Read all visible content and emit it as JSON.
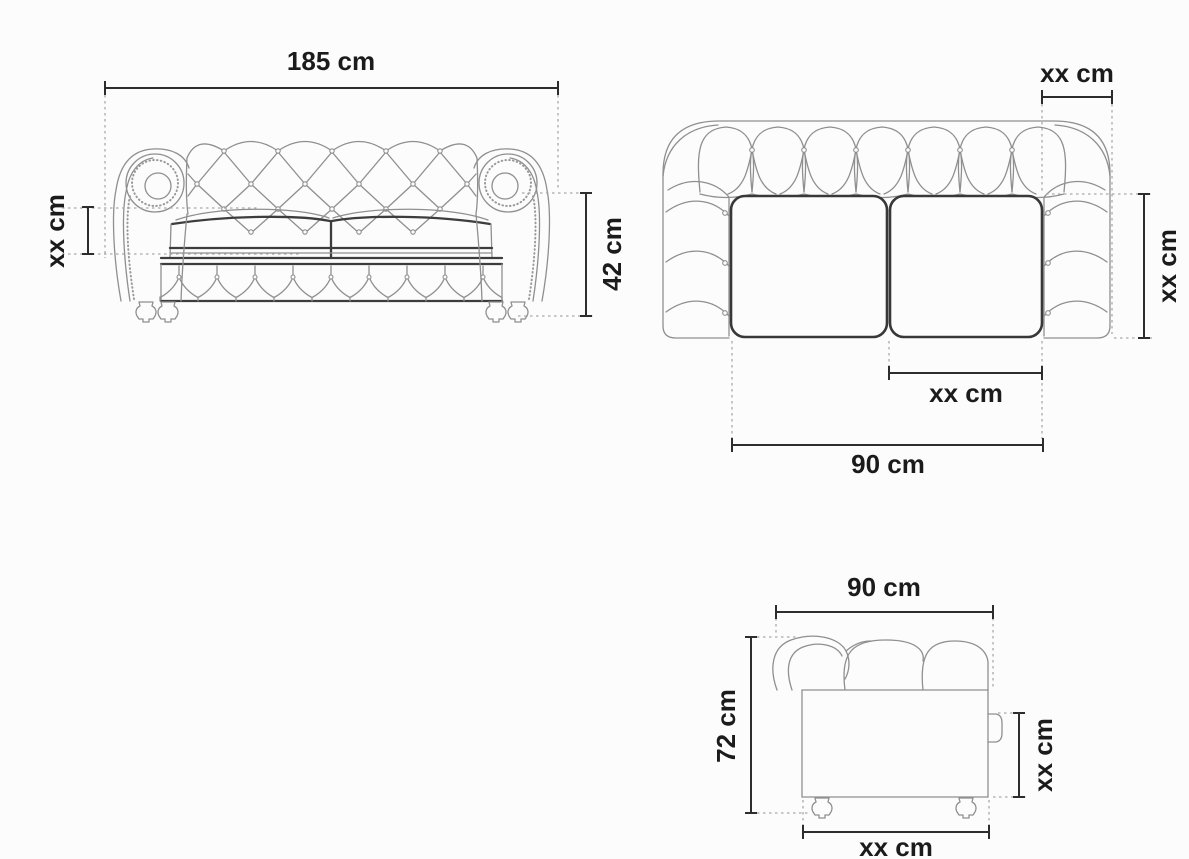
{
  "diagram": {
    "type": "furniture-dimension-drawing",
    "subject": "Chesterfield two-seater sofa shown in front, top and side views",
    "unit": "cm",
    "colors": {
      "background": "#fcfcfc",
      "artwork_line": "#8f8f8f",
      "dimension_line": "#2d2d2d",
      "extension_line": "#a8a8a8",
      "label_text": "#1b1b1b"
    },
    "views": {
      "front": {
        "name": "Front view",
        "dims": {
          "overall_width": {
            "label": "185 cm"
          },
          "seat_cushion_height": {
            "label": "xx cm"
          },
          "arm_height": {
            "label": "42 cm"
          }
        }
      },
      "top": {
        "name": "Top view",
        "dims": {
          "armrest_width": {
            "label": "xx cm"
          },
          "seat_depth": {
            "label": "xx cm"
          },
          "single_cushion_width": {
            "label": "xx cm"
          },
          "seat_width": {
            "label": "90 cm"
          }
        }
      },
      "side": {
        "name": "Side view",
        "dims": {
          "overall_depth": {
            "label": "90 cm"
          },
          "overall_height": {
            "label": "72 cm"
          },
          "back_panel_height": {
            "label": "xx cm"
          },
          "base_depth": {
            "label": "xx cm"
          }
        }
      }
    }
  }
}
